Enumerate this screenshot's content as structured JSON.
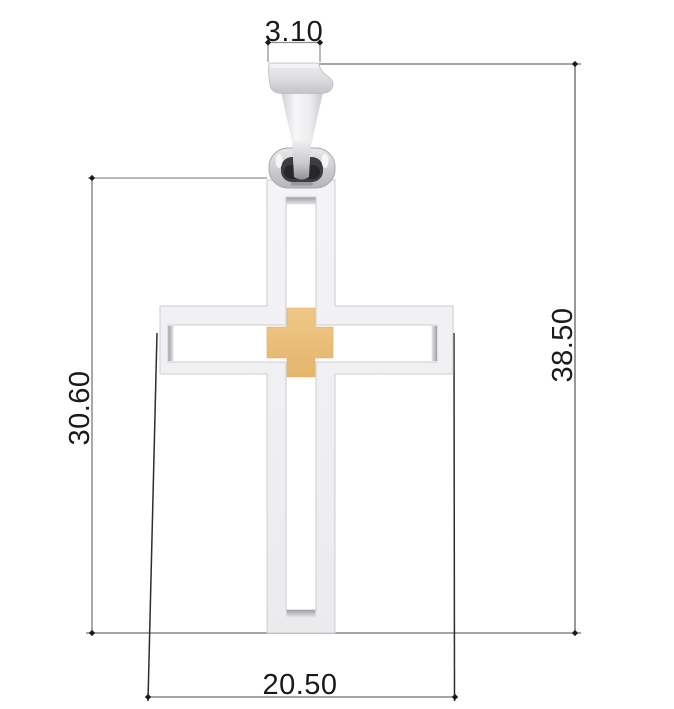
{
  "drawing": {
    "kind": "technical-drawing",
    "subject": "cross-pendant-with-bail-and-gold-center-inlay"
  },
  "dimensions": {
    "bail_width": {
      "value": "3.10"
    },
    "overall_height": {
      "value": "38.50"
    },
    "cross_height": {
      "value": "30.60"
    },
    "cross_width": {
      "value": "20.50"
    }
  },
  "colors": {
    "background": "#ffffff",
    "metal": "#f1f1f3",
    "metal_edge": "#cdcdd2",
    "metal_wall_shadow": "#a3a3a9",
    "gold": "#eac17c",
    "gold_edge": "#dfae63",
    "dim_line": "#8c8c90",
    "dim_ext_dark": "#2e2e32",
    "dim_text": "#1a1a1a",
    "tick": "#1a1a1a"
  }
}
